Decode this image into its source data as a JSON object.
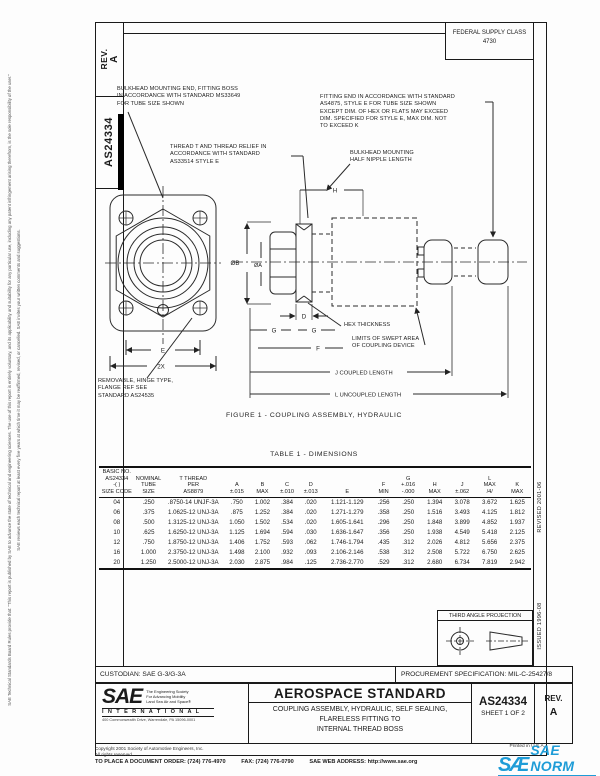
{
  "margins": {
    "left_note_1": "SAE Technical Standards Board Rules provide that: “This report is published by SAE to advance the state of technical and engineering sciences. The use of this report is entirely voluntary, and its applicability and suitability for any particular use, including any patent infringement arising therefrom, is the sole responsibility of the user.”",
    "left_note_2": "SAE reviews each technical report at least every five years at which time it may be reaffirmed, revised, or cancelled. SAE invites your written comments and suggestions.",
    "revised": "REVISED 2001-06",
    "issued": "ISSUED 1996-08"
  },
  "header": {
    "rev_label": "REV.",
    "rev_value": "A",
    "doc_number": "AS24334",
    "fsc_line1": "FEDERAL SUPPLY CLASS",
    "fsc_line2": "4730"
  },
  "drawing": {
    "annotations": {
      "bulkhead_note": "BULKHEAD MOUNTING END, FITTING BOSS\nIN ACCORDANCE WITH STANDARD MS33649\nFOR TUBE SIZE SHOWN",
      "thread_note": "THREAD T AND THREAD RELIEF IN\nACCORDANCE WITH STANDARD\nAS33514 STYLE E",
      "fitting_note": "FITTING END IN ACCORDANCE WITH STANDARD\nAS4875, STYLE E FOR TUBE SIZE SHOWN\nEXCEPT DIM. OF HEX OR FLATS MAY EXCEED\nDIM. SPECIFIED FOR STYLE E, MAX DIM. NOT\nTO EXCEED K",
      "half_nipple_note": "BULKHEAD MOUNTING\nHALF NIPPLE LENGTH",
      "hex_thickness_note": "HEX THICKNESS",
      "swept_note": "LIMITS OF SWEPT AREA\nOF COUPLING DEVICE",
      "removable_note": "REMOVABLE, HINGE TYPE,\nFLANGE REF SEE\nSTANDARD AS24535"
    },
    "dims": {
      "dia_b": "ØB",
      "dia_a": "ØA",
      "h": "H",
      "d": "D",
      "g1": "G",
      "g2": "G",
      "f": "F",
      "e": "E",
      "two_x": "2X",
      "coupled": "J  COUPLED LENGTH",
      "uncoupled": "L  UNCOUPLED LENGTH"
    },
    "figure_caption": "FIGURE 1 - COUPLING ASSEMBLY, HYDRAULIC"
  },
  "table": {
    "title": "TABLE 1 - DIMENSIONS",
    "columns": [
      "BASIC NO.\nAS24334\n-( )\nSIZE CODE",
      "NOMINAL\nTUBE\nSIZE",
      "T THREAD\nPER\nAS8879",
      "A\n±.015",
      "B\nMAX",
      "C\n±.010",
      "D\n±.013",
      "E",
      "F\nMIN",
      "G\n+.016\n-.000",
      "H\nMAX",
      "J\n±.062",
      "L\nMAX\n/4/",
      "K\nMAX"
    ],
    "rows": [
      [
        "04",
        ".250",
        ".8750-14 UNJF-3A",
        ".750",
        "1.002",
        ".384",
        ".020",
        "1.121-1.129",
        ".256",
        ".250",
        "1.394",
        "3.078",
        "3.672",
        "1.625"
      ],
      [
        "06",
        ".375",
        "1.0625-12 UNJ-3A",
        ".875",
        "1.252",
        ".384",
        ".020",
        "1.271-1.279",
        ".358",
        ".250",
        "1.516",
        "3.493",
        "4.125",
        "1.812"
      ],
      [
        "08",
        ".500",
        "1.3125-12 UNJ-3A",
        "1.050",
        "1.502",
        ".534",
        ".020",
        "1.605-1.641",
        ".296",
        ".250",
        "1.848",
        "3.899",
        "4.852",
        "1.937"
      ],
      [
        "10",
        ".625",
        "1.6250-12 UNJ-3A",
        "1.125",
        "1.694",
        ".594",
        ".030",
        "1.636-1.647",
        ".356",
        ".250",
        "1.938",
        "4.549",
        "5.418",
        "2.125"
      ],
      [
        "12",
        ".750",
        "1.8750-12 UNJ-3A",
        "1.406",
        "1.752",
        ".593",
        ".062",
        "1.746-1.794",
        ".435",
        ".312",
        "2.026",
        "4.812",
        "5.656",
        "2.375"
      ],
      [
        "16",
        "1.000",
        "2.3750-12 UNJ-3A",
        "1.498",
        "2.100",
        ".932",
        ".093",
        "2.106-2.146",
        ".538",
        ".312",
        "2.508",
        "5.722",
        "6.750",
        "2.625"
      ],
      [
        "20",
        "1.250",
        "2.5000-12 UNJ-3A",
        "2.030",
        "2.875",
        ".984",
        ".125",
        "2.736-2.770",
        ".529",
        ".312",
        "2.680",
        "6.734",
        "7.819",
        "2.942"
      ]
    ]
  },
  "projection": {
    "label": "THIRD ANGLE PROJECTION"
  },
  "title_block": {
    "custodian": "CUSTODIAN:  SAE G-3/G-3A",
    "procurement": "PROCUREMENT SPECIFICATION: MIL-C-25427/8",
    "standard_type": "AEROSPACE STANDARD",
    "title": "COUPLING ASSEMBLY, HYDRAULIC, SELF SEALING,\nFLARELESS FITTING TO\nINTERNAL THREAD BOSS",
    "doc_number": "AS24334",
    "sheet": "SHEET 1 OF 2",
    "rev_label": "REV.",
    "rev_value": "A",
    "logo": {
      "sae": "SAE",
      "tagline": "The Engineering Society\nFor Advancing Mobility\nLand Sea Air and Space®",
      "international": "I N T E R N A T I O N A L",
      "address": "400 Commonwealth Drive, Warrendale, PA 15096-0001"
    }
  },
  "footer": {
    "copyright": "Copyright 2001 Society of Automotive Engineers, Inc.",
    "rights": "All rights reserved.",
    "order": "TO PLACE A DOCUMENT ORDER:   (724) 776-4970",
    "fax": "FAX:   (724) 776-0790",
    "web": "SAE WEB ADDRESS:   http://www.sae.org",
    "printed": "Printed in U.S.A.",
    "norm_glyph": "SÆ",
    "norm_text": "SAE NORM",
    "norm_sub": "INTERNATIONAL"
  }
}
